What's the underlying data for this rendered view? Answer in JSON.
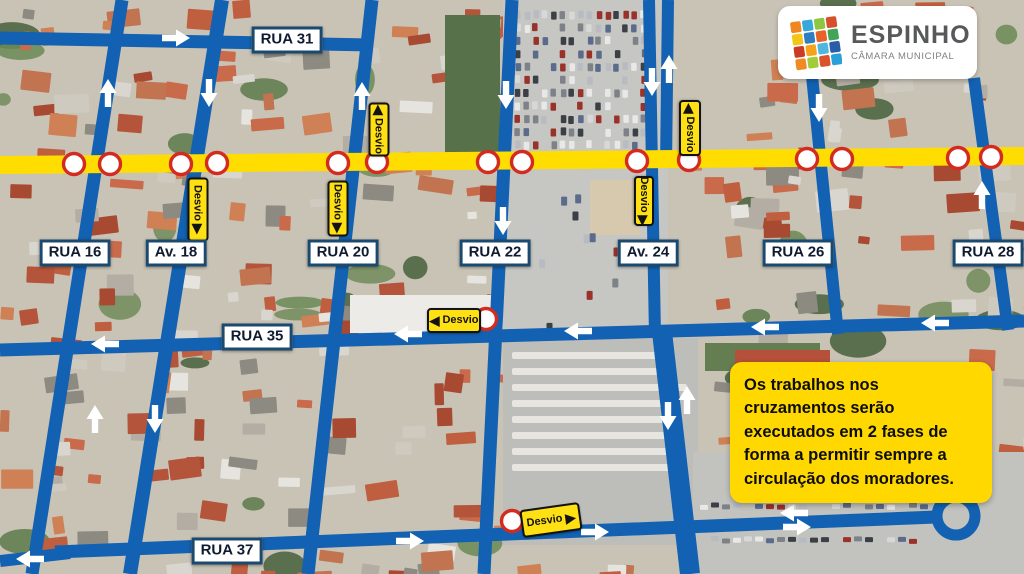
{
  "logo": {
    "title": "ESPINHO",
    "subtitle": "CÂMARA MUNICIPAL",
    "icon_colors": [
      "#f0861f",
      "#35a8dc",
      "#8dc63f",
      "#d6502b",
      "#f3c517",
      "#2f7ec1",
      "#e8622a",
      "#41a457",
      "#ca3a27",
      "#f5a31b",
      "#4fb6e0",
      "#2a5ca8",
      "#ef8b22",
      "#a2cb3a",
      "#d9532b",
      "#2aa0d8"
    ]
  },
  "note": {
    "text": "Os trabalhos nos cruzamentos serão executados em 2 fases de forma a permitir sempre a circulação dos moradores."
  },
  "colors": {
    "road": "#1261b2",
    "closed_road": "#ffdd00",
    "sign_yellow": "#ffe012",
    "note_bg": "#ffd800",
    "no_entry_red": "#d42b20",
    "label_border": "#1c4a6e",
    "arrow_white": "#ffffff"
  },
  "map": {
    "street_labels": [
      {
        "id": "rua-31",
        "text": "RUA 31",
        "x": 287,
        "y": 40
      },
      {
        "id": "rua-16",
        "text": "RUA 16",
        "x": 75,
        "y": 253
      },
      {
        "id": "av-18",
        "text": "Av. 18",
        "x": 176,
        "y": 253
      },
      {
        "id": "rua-20",
        "text": "RUA 20",
        "x": 343,
        "y": 253
      },
      {
        "id": "rua-22",
        "text": "RUA 22",
        "x": 495,
        "y": 253
      },
      {
        "id": "av-24",
        "text": "Av. 24",
        "x": 648,
        "y": 253
      },
      {
        "id": "rua-26",
        "text": "RUA 26",
        "x": 798,
        "y": 253
      },
      {
        "id": "rua-28",
        "text": "RUA 28",
        "x": 988,
        "y": 253
      },
      {
        "id": "rua-35",
        "text": "RUA 35",
        "x": 257,
        "y": 337
      },
      {
        "id": "rua-37",
        "text": "RUA 37",
        "x": 227,
        "y": 551
      }
    ],
    "desvio_signs": [
      {
        "text": "Desvio",
        "x": 377,
        "y": 127,
        "w": 50,
        "h": 17,
        "rot": 90,
        "arrow": "start"
      },
      {
        "text": "Desvio",
        "x": 688,
        "y": 126,
        "w": 52,
        "h": 18,
        "rot": 90,
        "arrow": "start"
      },
      {
        "text": "Desvio",
        "x": 336,
        "y": 206,
        "w": 52,
        "h": 17,
        "rot": 90,
        "arrow": "end"
      },
      {
        "text": "Desvio",
        "x": 196,
        "y": 207,
        "w": 60,
        "h": 17,
        "rot": 90,
        "arrow": "end"
      },
      {
        "text": "Desvio",
        "x": 642,
        "y": 199,
        "w": 46,
        "h": 16,
        "rot": 90,
        "arrow": "end"
      },
      {
        "text": "Desvio",
        "x": 452,
        "y": 318,
        "w": 50,
        "h": 21,
        "rot": 0,
        "arrow": "start"
      },
      {
        "text": "Desvio",
        "x": 549,
        "y": 518,
        "w": 56,
        "h": 24,
        "rot": -8,
        "arrow": "end"
      }
    ],
    "no_entry_signs": [
      [
        74,
        164
      ],
      [
        110,
        164
      ],
      [
        181,
        164
      ],
      [
        217,
        163
      ],
      [
        338,
        163
      ],
      [
        377,
        162
      ],
      [
        488,
        162
      ],
      [
        522,
        162
      ],
      [
        637,
        161
      ],
      [
        689,
        160
      ],
      [
        807,
        159
      ],
      [
        842,
        159
      ],
      [
        958,
        158
      ],
      [
        991,
        157
      ],
      [
        486,
        319
      ],
      [
        512,
        521
      ]
    ],
    "flow_arrows": [
      {
        "x": 108,
        "y": 93,
        "d": "up"
      },
      {
        "x": 209,
        "y": 93,
        "d": "down"
      },
      {
        "x": 362,
        "y": 96,
        "d": "up"
      },
      {
        "x": 506,
        "y": 95,
        "d": "down"
      },
      {
        "x": 652,
        "y": 82,
        "d": "down"
      },
      {
        "x": 669,
        "y": 69,
        "d": "up"
      },
      {
        "x": 819,
        "y": 108,
        "d": "down"
      },
      {
        "x": 982,
        "y": 195,
        "d": "up"
      },
      {
        "x": 176,
        "y": 38,
        "d": "right"
      },
      {
        "x": 503,
        "y": 221,
        "d": "down"
      },
      {
        "x": 105,
        "y": 344,
        "d": "left"
      },
      {
        "x": 408,
        "y": 334,
        "d": "left"
      },
      {
        "x": 578,
        "y": 331,
        "d": "left"
      },
      {
        "x": 765,
        "y": 327,
        "d": "left"
      },
      {
        "x": 935,
        "y": 323,
        "d": "left"
      },
      {
        "x": 95,
        "y": 419,
        "d": "up"
      },
      {
        "x": 155,
        "y": 419,
        "d": "down"
      },
      {
        "x": 668,
        "y": 416,
        "d": "down"
      },
      {
        "x": 687,
        "y": 400,
        "d": "up"
      },
      {
        "x": 410,
        "y": 541,
        "d": "right"
      },
      {
        "x": 595,
        "y": 532,
        "d": "right"
      },
      {
        "x": 794,
        "y": 513,
        "d": "left"
      },
      {
        "x": 797,
        "y": 527,
        "d": "right"
      },
      {
        "x": 30,
        "y": 559,
        "d": "left"
      }
    ],
    "roads": [
      {
        "n": "rua-31",
        "x1": 0,
        "y1": 38,
        "x2": 371,
        "y2": 45,
        "w": 13
      },
      {
        "n": "rua-35",
        "x1": 0,
        "y1": 350,
        "x2": 1024,
        "y2": 321,
        "w": 13
      },
      {
        "n": "rua-37",
        "x1": 55,
        "y1": 552,
        "x2": 936,
        "y2": 517,
        "w": 13
      },
      {
        "n": "rua-37-west",
        "x1": 0,
        "y1": 561,
        "x2": 70,
        "y2": 553,
        "w": 12
      },
      {
        "n": "rua-16",
        "x1": 122,
        "y1": 0,
        "x2": 32,
        "y2": 574,
        "w": 13
      },
      {
        "n": "av-18",
        "x1": 222,
        "y1": 0,
        "x2": 130,
        "y2": 574,
        "w": 14
      },
      {
        "n": "rua-20",
        "x1": 372,
        "y1": 0,
        "x2": 308,
        "y2": 574,
        "w": 13
      },
      {
        "n": "rua-22",
        "x1": 512,
        "y1": 0,
        "x2": 484,
        "y2": 574,
        "w": 13
      },
      {
        "n": "av-24-west",
        "x1": 649,
        "y1": 0,
        "x2": 655,
        "y2": 336,
        "w": 12
      },
      {
        "n": "av-24-east",
        "x1": 668,
        "y1": 0,
        "x2": 666,
        "y2": 166,
        "w": 12
      },
      {
        "n": "feira-east",
        "x1": 662,
        "y1": 332,
        "x2": 690,
        "y2": 574,
        "w": 20
      },
      {
        "n": "rua-26",
        "x1": 812,
        "y1": 76,
        "x2": 838,
        "y2": 334,
        "w": 12
      },
      {
        "n": "rua-28",
        "x1": 974,
        "y1": 78,
        "x2": 1008,
        "y2": 330,
        "w": 12
      }
    ],
    "closed_road": {
      "x1": 0,
      "y1": 165,
      "x2": 1024,
      "y2": 156,
      "w": 18
    },
    "roundabout": {
      "x": 956,
      "y": 516,
      "r": 19,
      "stroke": 11
    }
  }
}
